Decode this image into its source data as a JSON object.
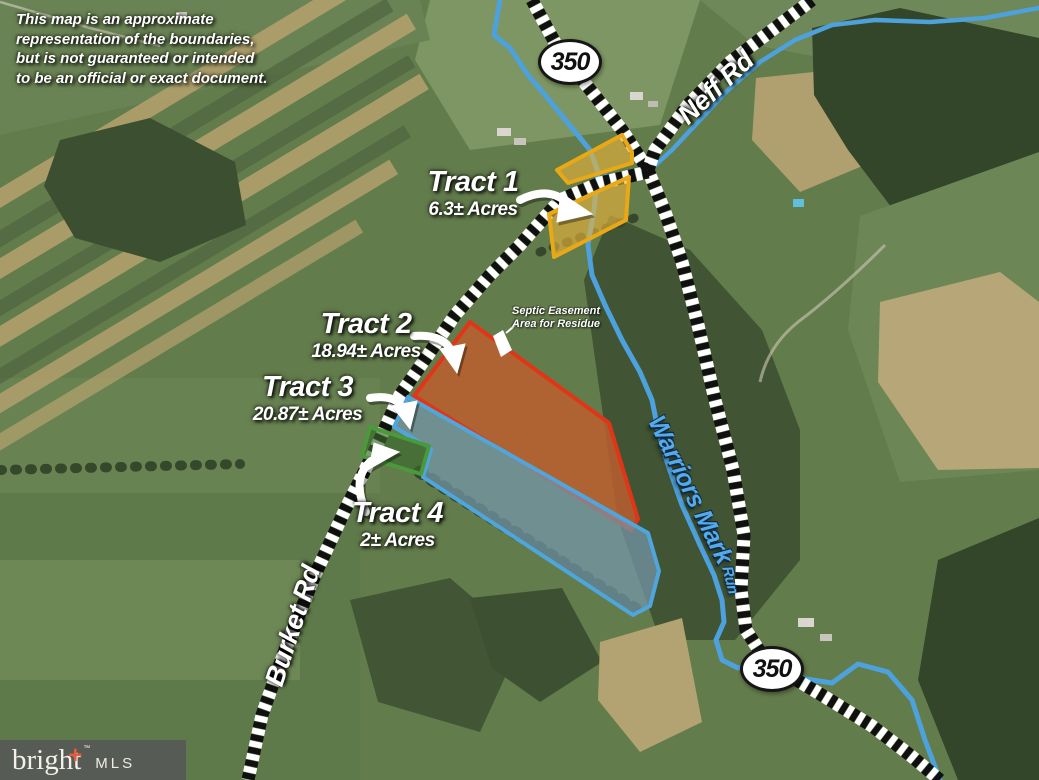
{
  "disclaimer": "This map is an approximate representation of the boundaries, but is not guaranteed or intended to be an official or exact document.",
  "route_shields": [
    {
      "label": "350"
    },
    {
      "label": "350"
    }
  ],
  "roads": [
    {
      "name": "Neff Rd"
    },
    {
      "name": "Burket Rd"
    }
  ],
  "stream": {
    "name": "Warriors Mark",
    "suffix": "Run"
  },
  "tracts": [
    {
      "id": 1,
      "title": "Tract 1",
      "acreage": "6.3± Acres",
      "border": "#e9a816",
      "fill": "#ecb53a"
    },
    {
      "id": 2,
      "title": "Tract 2",
      "acreage": "18.94± Acres",
      "border": "#e13517",
      "fill": "#bf5e2e"
    },
    {
      "id": 3,
      "title": "Tract 3",
      "acreage": "20.87± Acres",
      "border": "#4fa6dc",
      "fill": "#7497ab"
    },
    {
      "id": 4,
      "title": "Tract 4",
      "acreage": "2± Acres",
      "border": "#4a9a3c",
      "fill": "#39682c"
    }
  ],
  "easement_note": {
    "line1": "Septic Easement",
    "line2": "Area for Residue"
  },
  "logo": {
    "brand": "bright",
    "plus": "+",
    "tm": "™",
    "suffix": "MLS"
  }
}
